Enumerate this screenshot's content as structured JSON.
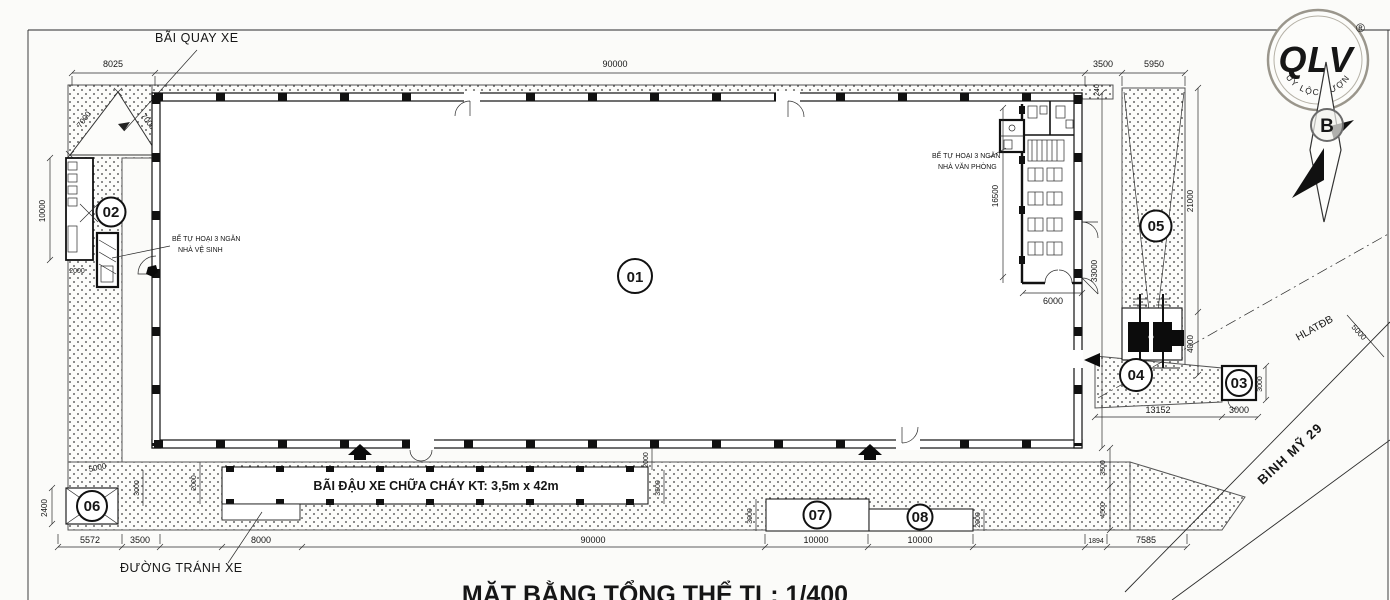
{
  "title": "MẶT BẰNG TỔNG THỂ TL: 1/400",
  "logo": {
    "text": "QLV",
    "reg": "®",
    "company": "QUY LỘC VƯỢNG",
    "north_letter": "B"
  },
  "labels": {
    "turning_area": "BÃI QUAY XE",
    "bypass_road": "ĐƯỜNG TRÁNH XE",
    "fire_parking": "BÃI ĐẬU XE CHỮA CHÁY KT: 3,5m x 42m",
    "septic_toilet_line1": "BỂ TỰ HOẠI 3 NGĂN",
    "septic_toilet_line2": "NHÀ VỆ SINH",
    "septic_office_line1": "BỂ TỰ HOẠI 3 NGĂN",
    "septic_office_line2": "NHÀ VĂN PHÒNG",
    "road_name": "BÌNH MỸ 29",
    "corridor": "HLATĐB"
  },
  "zones": {
    "z1": "01",
    "z2": "02",
    "z3": "03",
    "z4": "04",
    "z5": "05",
    "z6": "06",
    "z7": "07",
    "z8": "08"
  },
  "dims": {
    "top_8025": "8025",
    "top_90000": "90000",
    "top_3500": "3500",
    "top_5950": "5950",
    "diag_7000_a": "7000",
    "diag_7000_b": "7000",
    "left_10000": "10000",
    "left_2000": "2000",
    "left_5000": "5000",
    "left_2400": "2400",
    "lane_3000_l": "3000",
    "lane_2000_l": "2000",
    "lane_2000_r": "2000",
    "lane_3500_r": "3500",
    "right_33000": "33000",
    "right_3500": "3500",
    "right_4500": "4500",
    "right_240": "240",
    "strip_21000": "21000",
    "strip_4000": "4000",
    "strip_13152": "13152",
    "b03_3000_h": "3000",
    "b03_3000_v": "3000",
    "hl_5000": "5000",
    "office_16500": "16500",
    "office_6000": "6000",
    "mid_3000": "3000",
    "mid_2000": "2000",
    "bot_5572": "5572",
    "bot_3500": "3500",
    "bot_8000": "8000",
    "bot_90000": "90000",
    "bot_10000_a": "10000",
    "bot_10000_b": "10000",
    "bot_1894": "1894",
    "bot_7585": "7585"
  }
}
